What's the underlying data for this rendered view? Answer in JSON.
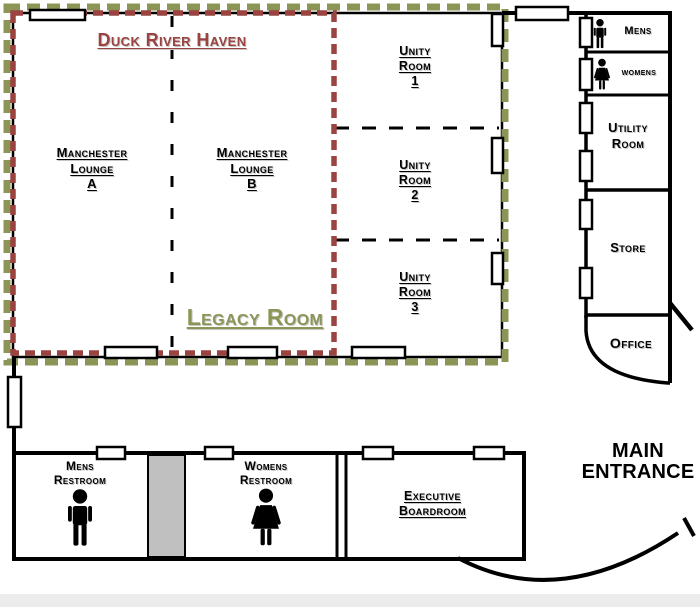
{
  "colors": {
    "haven_red": "#9a4340",
    "legacy_olive": "#8c9556",
    "wall_black": "#000000",
    "gray_block": "#c0c0c0"
  },
  "icons": {
    "man": "man-icon",
    "woman": "woman-icon"
  },
  "areas": {
    "duck_river_haven": {
      "label": "Duck River Haven"
    },
    "legacy_room": {
      "label": "Legacy Room"
    },
    "manchester_lounge_a": {
      "lines": [
        "Manchester",
        "Lounge",
        "A"
      ]
    },
    "manchester_lounge_b": {
      "lines": [
        "Manchester",
        "Lounge",
        "B"
      ]
    },
    "unity_room_1": {
      "lines": [
        "Unity",
        "Room",
        "1"
      ]
    },
    "unity_room_2": {
      "lines": [
        "Unity",
        "Room",
        "2"
      ]
    },
    "unity_room_3": {
      "lines": [
        "Unity",
        "Room",
        "3"
      ]
    },
    "mens_wc": {
      "label": "Mens"
    },
    "womens_wc": {
      "label": "womens"
    },
    "utility_room": {
      "lines": [
        "Utility",
        "Room"
      ]
    },
    "store": {
      "label": "Store"
    },
    "office": {
      "label": "Office"
    },
    "mens_restroom": {
      "lines": [
        "Mens",
        "Restroom"
      ]
    },
    "womens_restroom": {
      "lines": [
        "Womens",
        "Restroom"
      ]
    },
    "executive_boardroom": {
      "lines": [
        "Executive",
        "Boardroom"
      ]
    },
    "main_entrance": {
      "lines": [
        "MAIN",
        "ENTRANCE"
      ]
    }
  }
}
